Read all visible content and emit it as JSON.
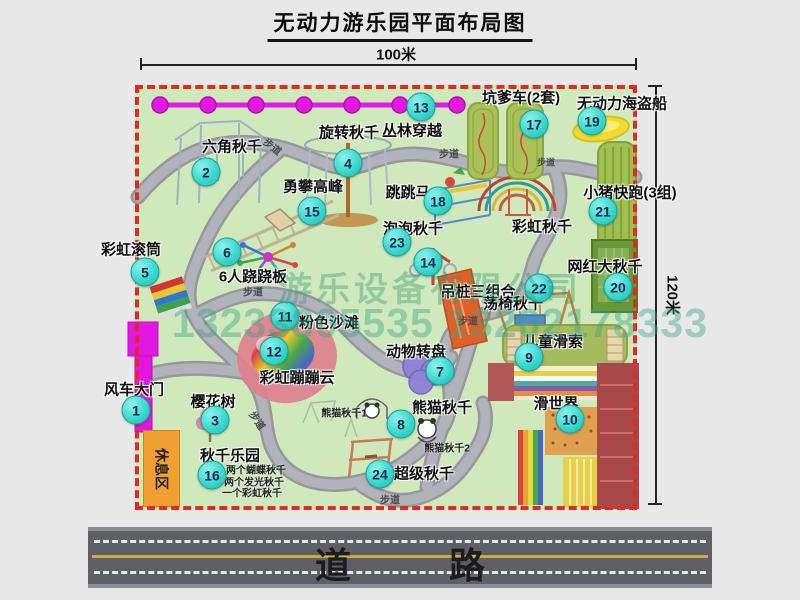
{
  "title": "无动力游乐园平面布局图",
  "scale": {
    "top": "100米",
    "right": "120米"
  },
  "road": {
    "label": "道 路"
  },
  "watermark": {
    "company": "游乐设备有限公司",
    "phone": "13233805535 13202178333"
  },
  "labels": {
    "walkway": "步道",
    "rest_area": "休息区",
    "rainbow_swing": "彩虹秋千"
  },
  "attractions": [
    {
      "num": "1",
      "name": "风车大门"
    },
    {
      "num": "2",
      "name": "六角秋千"
    },
    {
      "num": "3",
      "name": "樱花树"
    },
    {
      "num": "4",
      "name": "旋转秋千"
    },
    {
      "num": "5",
      "name": "彩虹滚筒"
    },
    {
      "num": "6",
      "name": "6人跷跷板"
    },
    {
      "num": "7",
      "name": "动物转盘"
    },
    {
      "num": "8",
      "name": "熊猫秋千",
      "notes": [
        "熊猫秋千1",
        "熊猫秋千2"
      ]
    },
    {
      "num": "9",
      "name": "儿童滑索"
    },
    {
      "num": "10",
      "name": "滑世界"
    },
    {
      "num": "11",
      "name": "粉色沙滩"
    },
    {
      "num": "12",
      "name": "彩虹蹦蹦云"
    },
    {
      "num": "13",
      "name": "丛林穿越"
    },
    {
      "num": "14",
      "name": "吊桩三组合"
    },
    {
      "num": "15",
      "name": "勇攀高峰"
    },
    {
      "num": "16",
      "name": "秋千乐园",
      "notes": [
        "两个蝴蝶秋千",
        "两个发光秋千",
        "一个彩虹秋千"
      ]
    },
    {
      "num": "17",
      "name": "坑爹车(2套)"
    },
    {
      "num": "18",
      "name": "跳跳马"
    },
    {
      "num": "19",
      "name": "无动力海盗船"
    },
    {
      "num": "20",
      "name": "网红大秋千"
    },
    {
      "num": "21",
      "name": "小猪快跑(3组)"
    },
    {
      "num": "22",
      "name": "荡椅秋千"
    },
    {
      "num": "23",
      "name": "泡泡秋千"
    },
    {
      "num": "24",
      "name": "超级秋千"
    }
  ]
}
